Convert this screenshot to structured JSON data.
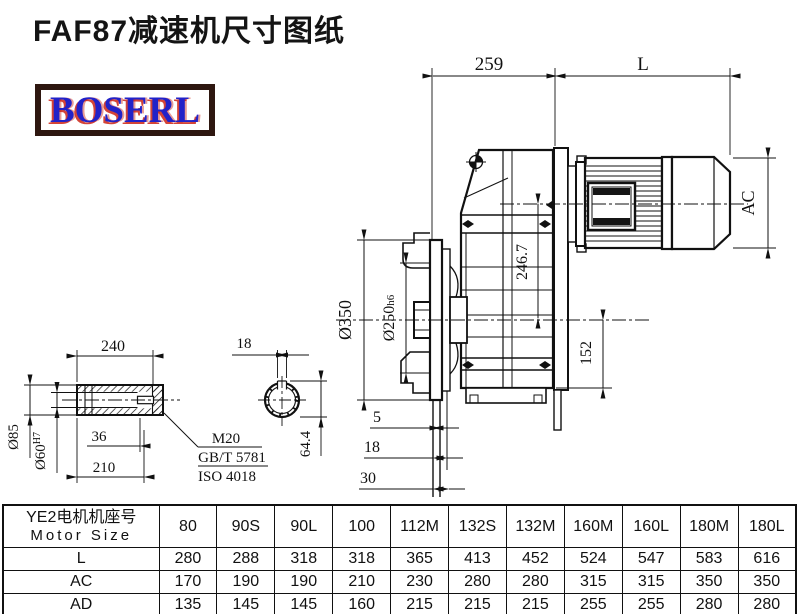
{
  "title": "FAF87减速机尺寸图纸",
  "logo": {
    "text": "BOSERL"
  },
  "drawing": {
    "top_dims": {
      "gearbox_width": "259",
      "motor_length": "L"
    },
    "motor": {
      "diameter_label": "AC"
    },
    "main_dims": {
      "flange_diameter": "Ø350",
      "spigot_diameter": "Ø250",
      "spigot_tolerance": "h6",
      "center_height": "246.7",
      "bottom_height": "152",
      "flange_offset_5": "5",
      "flange_offset_18": "18",
      "flange_offset_30": "30"
    },
    "shaft_detail": {
      "length_240": "240",
      "shaft_diameter": "Ø85",
      "bore_diameter": "Ø60",
      "bore_tolerance": "H7",
      "thread_depth_36": "36",
      "length_210": "210",
      "thread_callout": "M20",
      "standard_gb": "GB/T 5781",
      "standard_iso": "ISO 4018"
    },
    "section_view": {
      "key_width": "18",
      "key_height": "64.4"
    }
  },
  "table": {
    "header_cn": "YE2电机机座号",
    "header_en": "Motor Size",
    "columns": [
      "80",
      "90S",
      "90L",
      "100",
      "112M",
      "132S",
      "132M",
      "160M",
      "160L",
      "180M",
      "180L"
    ],
    "rows": [
      {
        "label": "L",
        "values": [
          "280",
          "288",
          "318",
          "318",
          "365",
          "413",
          "452",
          "524",
          "547",
          "583",
          "616"
        ]
      },
      {
        "label": "AC",
        "values": [
          "170",
          "190",
          "190",
          "210",
          "230",
          "280",
          "280",
          "315",
          "315",
          "350",
          "350"
        ]
      },
      {
        "label": "AD",
        "values": [
          "135",
          "145",
          "145",
          "160",
          "215",
          "215",
          "215",
          "255",
          "255",
          "280",
          "280"
        ]
      }
    ]
  }
}
